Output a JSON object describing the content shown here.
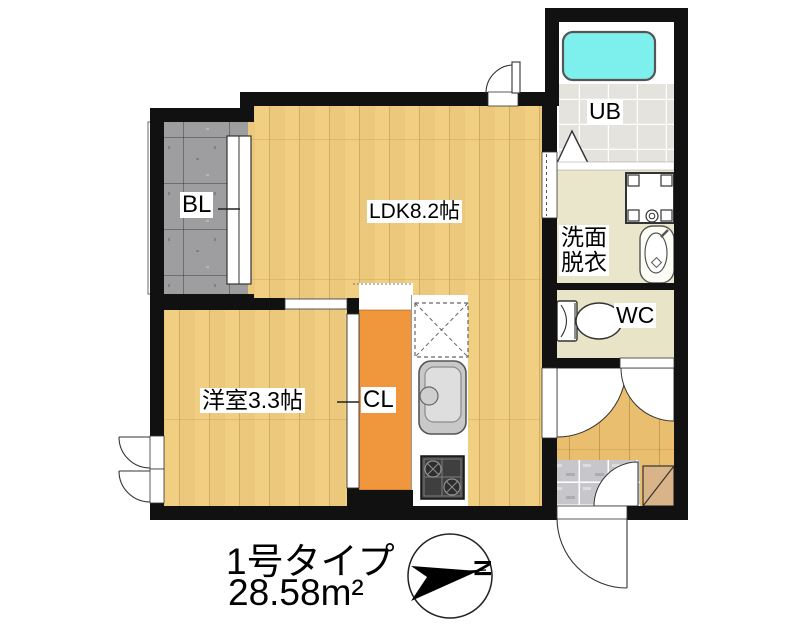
{
  "plan": {
    "unit_type_label": "1号タイプ",
    "floor_area_label": "28.58m²",
    "compass": {
      "north_label": "N"
    },
    "rooms": {
      "balcony_label": "BL",
      "ldk_label": "LDK8.2帖",
      "unit_bath_label": "UB",
      "washroom_label_line1": "洗面",
      "washroom_label_line2": "脱衣",
      "toilet_label": "WC",
      "bedroom_label": "洋室3.3帖",
      "closet_label": "CL"
    },
    "colors": {
      "wall": "#111111",
      "wood": "#F0CE82",
      "wood_hall": "#E9BE6F",
      "balcony": "#9E9EA0",
      "closet": "#F0973E",
      "bathtub": "#7DF0EE",
      "ub_tile": "#E5E3DE",
      "washroom_floor": "#E9E6CB",
      "wc_floor": "#E7E4C8",
      "genkan_tile": "#C7C7CB",
      "shoe_box": "#D9B488"
    }
  }
}
